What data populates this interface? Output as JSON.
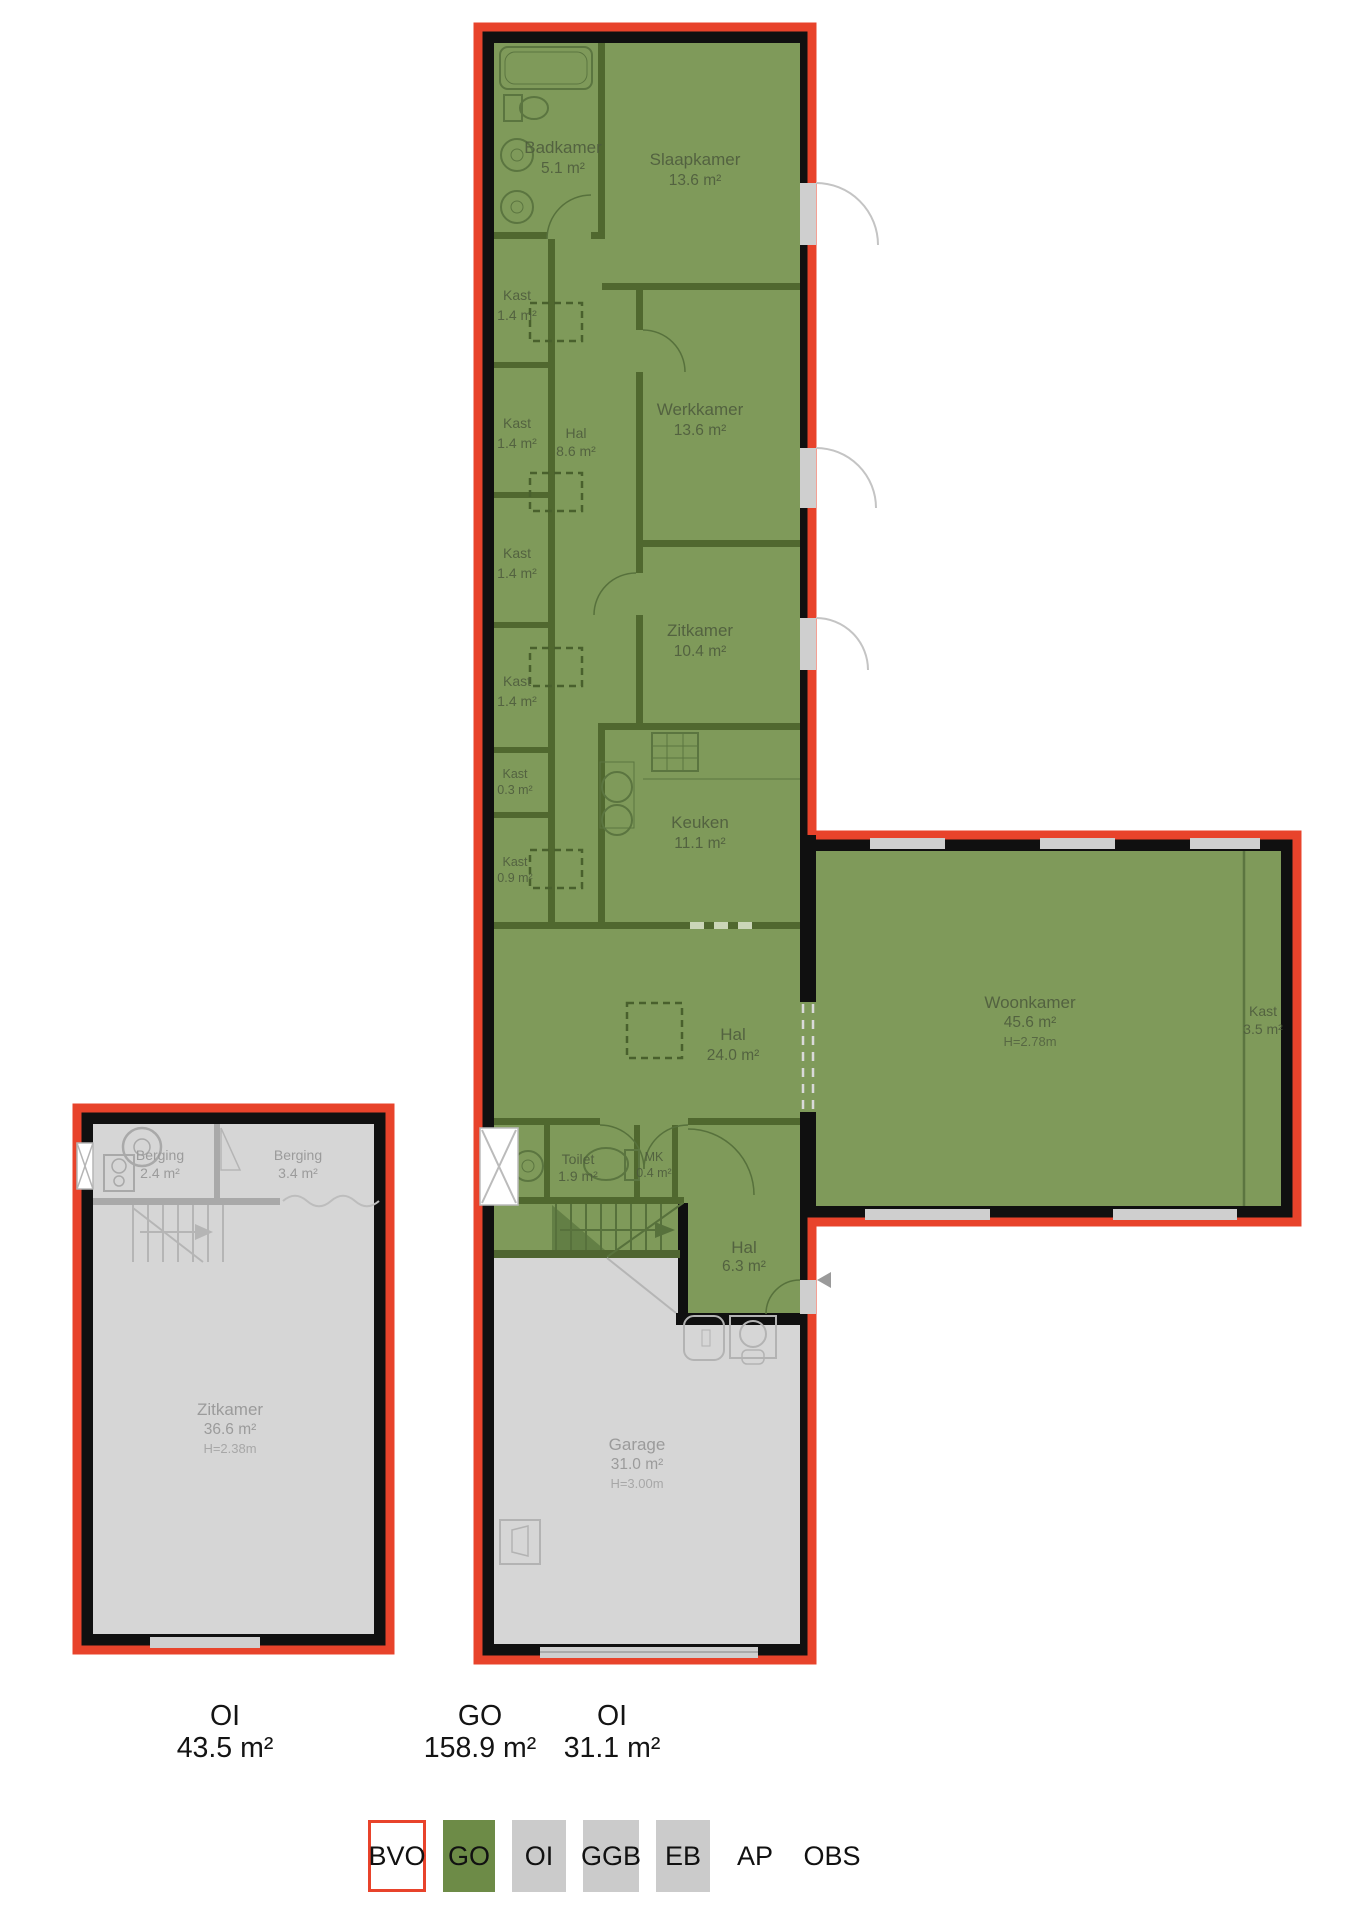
{
  "plan": {
    "main": {
      "badkamer": {
        "name": "Badkamer",
        "area": "5.1 m²"
      },
      "slaapkamer": {
        "name": "Slaapkamer",
        "area": "13.6 m²"
      },
      "kast1": {
        "name": "Kast",
        "area": "1.4 m²"
      },
      "kast2": {
        "name": "Kast",
        "area": "1.4 m²"
      },
      "kast3": {
        "name": "Kast",
        "area": "1.4 m²"
      },
      "kast4": {
        "name": "Kast",
        "area": "1.4 m²"
      },
      "kast5": {
        "name": "Kast",
        "area": "0.3 m²"
      },
      "kast6": {
        "name": "Kast",
        "area": "0.9 m²"
      },
      "hal1": {
        "name": "Hal",
        "area": "8.6 m²"
      },
      "werkkamer": {
        "name": "Werkkamer",
        "area": "13.6 m²"
      },
      "zitkamer": {
        "name": "Zitkamer",
        "area": "10.4 m²"
      },
      "keuken": {
        "name": "Keuken",
        "area": "11.1 m²"
      },
      "hal2": {
        "name": "Hal",
        "area": "24.0 m²"
      },
      "woonkamer": {
        "name": "Woonkamer",
        "area": "45.6 m²",
        "height": "H=2.78m"
      },
      "kast7": {
        "name": "Kast",
        "area": "3.5 m²"
      },
      "toilet": {
        "name": "Toilet",
        "area": "1.9 m²"
      },
      "mk": {
        "name": "MK",
        "area": "0.4 m²"
      },
      "hal3": {
        "name": "Hal",
        "area": "6.3 m²"
      },
      "garage": {
        "name": "Garage",
        "area": "31.0 m²",
        "height": "H=3.00m"
      }
    },
    "annex": {
      "berging1": {
        "name": "Berging",
        "area": "2.4 m²"
      },
      "berging2": {
        "name": "Berging",
        "area": "3.4 m²"
      },
      "zitkamer": {
        "name": "Zitkamer",
        "area": "36.6 m²",
        "height": "H=2.38m"
      }
    }
  },
  "totals": {
    "left": {
      "label": "OI",
      "value": "43.5 m²"
    },
    "center": {
      "label": "GO",
      "value": "158.9 m²"
    },
    "right": {
      "label": "OI",
      "value": "31.1 m²"
    }
  },
  "legend": {
    "bvo": "BVO",
    "go": "GO",
    "oi": "OI",
    "ggb": "GGB",
    "eb": "EB",
    "ap": "AP",
    "obs": "OBS"
  },
  "colors": {
    "bvo_outline_red": "#e8432b",
    "go_green": "#6d8b47",
    "go_fill": "#7f9a5a",
    "oi_gray": "#cbcbcb",
    "oi_fill": "#d6d6d6",
    "wall_black": "#101010"
  }
}
